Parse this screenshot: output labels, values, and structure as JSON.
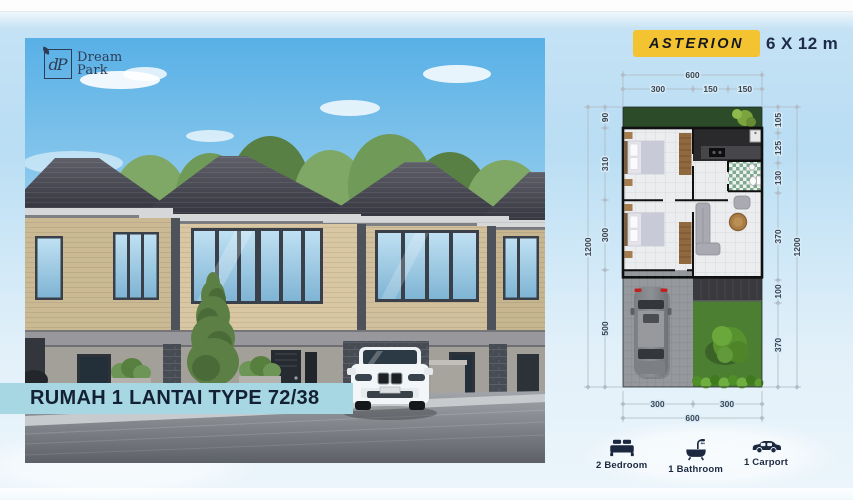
{
  "brand": {
    "monogram": "dP",
    "name_line1": "Dream",
    "name_line2": "Park"
  },
  "header": {
    "product_name": "ASTERION",
    "lot_size": "6 X 12 m"
  },
  "photo_caption": {
    "text": "RUMAH 1 LANTAI TYPE 72/38"
  },
  "floorplan": {
    "top": {
      "total": "600",
      "segments": [
        "300",
        "150",
        "150"
      ]
    },
    "bottom": {
      "total": "600",
      "segments": [
        "300",
        "300"
      ]
    },
    "left": {
      "total": "1200",
      "segments": [
        "90",
        "310",
        "300",
        "500"
      ]
    },
    "right": {
      "total": "1200",
      "segments": [
        "105",
        "125",
        "130",
        "370",
        "100",
        "370"
      ]
    }
  },
  "features": [
    {
      "icon": "bed-icon",
      "label": "2 Bedroom"
    },
    {
      "icon": "bathtub-icon",
      "label": "1 Bathroom"
    },
    {
      "icon": "car-icon",
      "label": "1 Carport"
    }
  ],
  "colors": {
    "badge_bg": "#F4C332",
    "badge_text": "#14181E",
    "banner_bg": "#A6D7E2",
    "navy": "#1B2840",
    "caption_text": "#142033"
  }
}
